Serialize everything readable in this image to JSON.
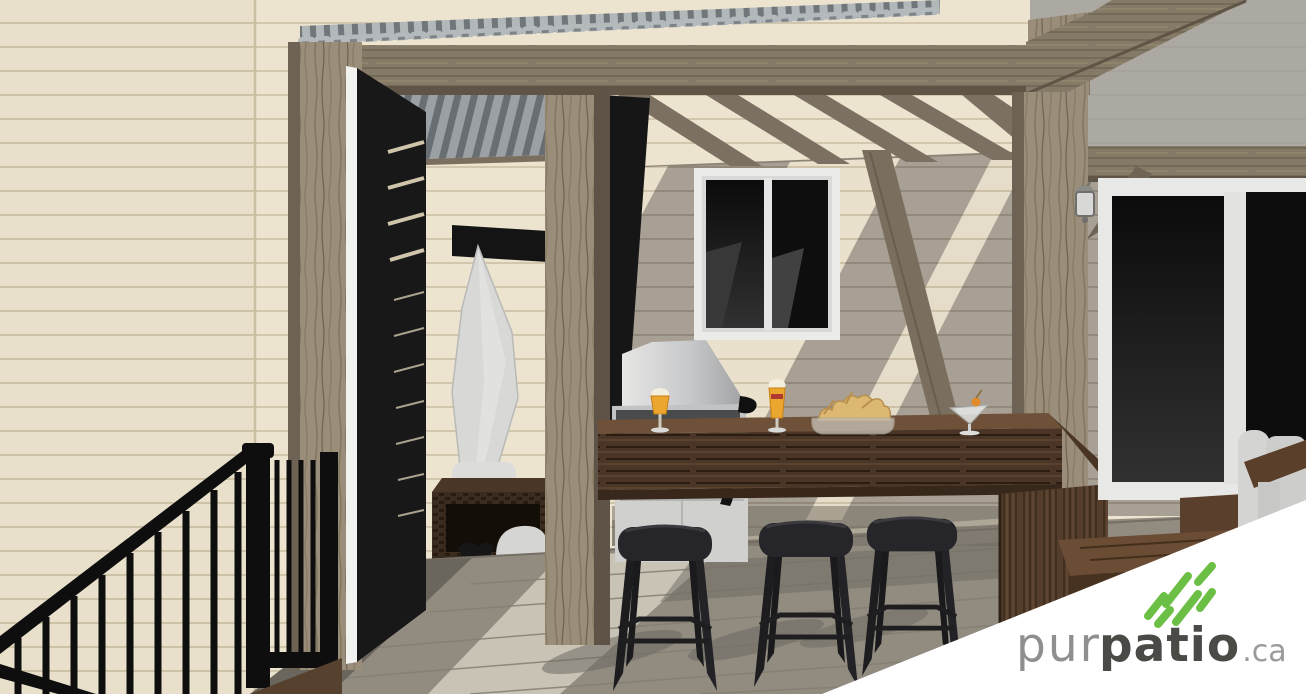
{
  "brand": {
    "prefix": "pur",
    "name": "patio",
    "tld": ".ca"
  },
  "logo_colors": {
    "green": "#6cbf45",
    "prefix_gray": "#8f8f8d",
    "name_dark": "#4a4a47",
    "tld_gray": "#9a9a98"
  },
  "scene": {
    "type": "3d-architectural-rendering",
    "setting": "covered backyard patio with pergola, privacy door and outdoor bar",
    "palette": {
      "siding_sunlit": "#ece4cf",
      "siding_shadow": "#a8a094",
      "pergola_wood": "#8d8170",
      "deck_floor": "#c6c0b4",
      "counter_wood": "#4a3526",
      "accent_black": "#161616",
      "metal_roof": "#b2b7ba"
    },
    "objects": [
      "corrugated-metal-roof",
      "pergola-beam",
      "pergola-rafters",
      "wood-post",
      "black-slat-privacy-door",
      "hanging-towel",
      "towel-rack",
      "wicker-storage-bench",
      "window",
      "bbq-grill",
      "grill-cart",
      "bar-counter",
      "beer-glass",
      "beer-glass",
      "chip-bowl",
      "martini-glass",
      "bar-stool",
      "bar-stool",
      "bar-stool",
      "black-stair-railing",
      "deck-floor",
      "patio-sliding-door",
      "wall-sconce",
      "wood-steps",
      "adirondack-chair"
    ]
  }
}
